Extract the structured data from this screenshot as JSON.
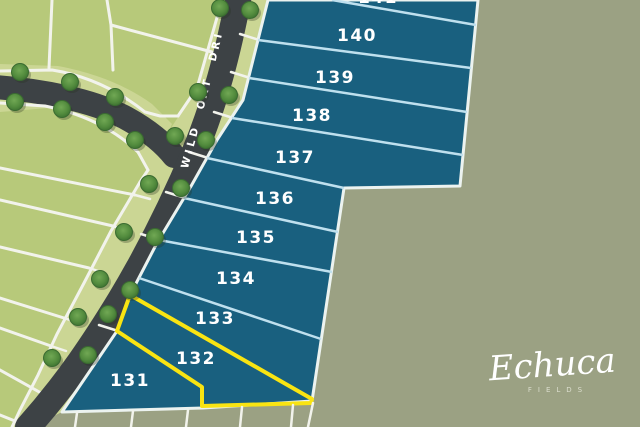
{
  "road": {
    "label": "WILD OAT DRIVE"
  },
  "lots": [
    {
      "label": "141",
      "highlighted": false
    },
    {
      "label": "140",
      "highlighted": false
    },
    {
      "label": "139",
      "highlighted": false
    },
    {
      "label": "138",
      "highlighted": false
    },
    {
      "label": "137",
      "highlighted": false
    },
    {
      "label": "136",
      "highlighted": false
    },
    {
      "label": "135",
      "highlighted": false
    },
    {
      "label": "134",
      "highlighted": false
    },
    {
      "label": "133",
      "highlighted": false
    },
    {
      "label": "132",
      "highlighted": true
    },
    {
      "label": "131",
      "highlighted": false
    }
  ],
  "logo": {
    "brand": "Echuca",
    "tagline": "FIELDS"
  },
  "colors": {
    "estate_blue": "#19607f",
    "highlight_yellow": "#f9e412",
    "divider_blue": "#bfe0ee",
    "background_sage": "#9ba183",
    "field_green": "#b7c97a",
    "verge_green": "#cbd694",
    "road_gray": "#3d4245",
    "tree_green": "#4f8a3c",
    "boundary_white": "#f2f3ec"
  }
}
